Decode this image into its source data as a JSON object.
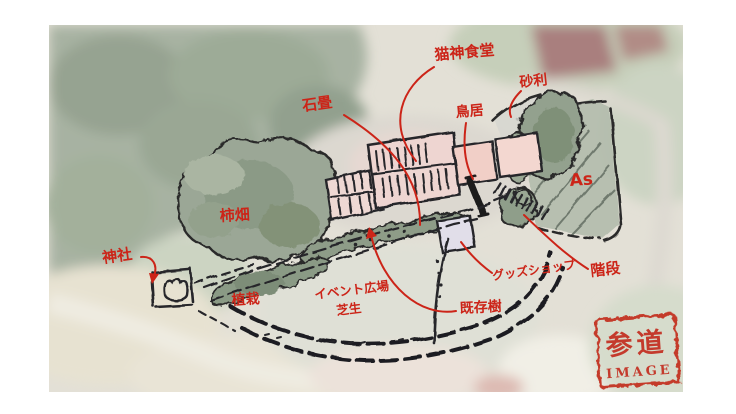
{
  "labels": {
    "restaurant": "猫神食堂",
    "gravel": "砂利",
    "stone_pavement": "石畳",
    "torii": "鳥居",
    "asphalt": "As",
    "persimmon_orchard": "柿畑",
    "shrine": "神社",
    "planting": "植栽",
    "event_plaza": "イベント広場",
    "lawn": "芝生",
    "goods_shop": "グッズショップ",
    "existing_tree": "既存樹",
    "stairs": "階段"
  },
  "stamp": {
    "title": "参道",
    "subtitle": "IMAGE"
  },
  "colors": {
    "annotation_red": "#cc2418",
    "stamp_red": "#c43a2c",
    "sketch_ink": "#2b2b2b",
    "building_pink": "#eed5d1",
    "tree_green": "#93a18e",
    "asphalt_gray": "#b2bbac"
  }
}
